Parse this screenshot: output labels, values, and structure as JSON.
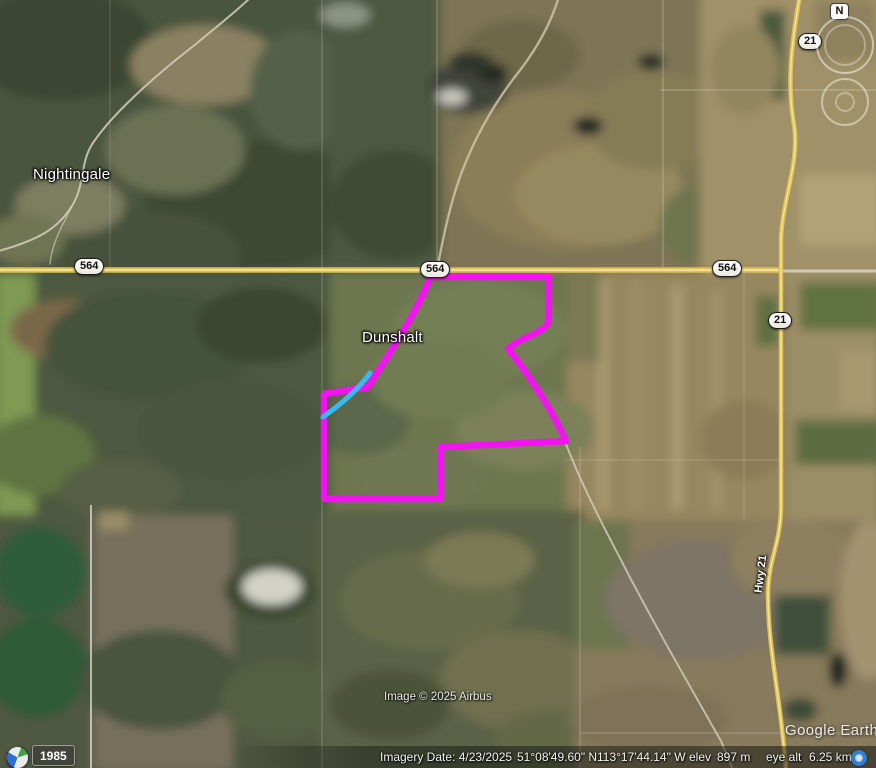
{
  "map": {
    "place_labels": {
      "nightingale": "Nightingale",
      "dunshalt": "Dunshalt"
    },
    "road_labels": {
      "hwy21": "Hwy 21"
    },
    "shields": {
      "hwy564": "564",
      "hwy21": "21"
    },
    "attribution": "Image © 2025 Airbus",
    "watermark": "Google Earth"
  },
  "navigation": {
    "north_label": "N"
  },
  "historical_imagery": {
    "year": "1985"
  },
  "status_bar": {
    "imagery_date": "Imagery Date: 4/23/2025",
    "latitude": "51°08'49.60\" N",
    "longitude": "113°17'44.14\" W",
    "elevation_label": "elev",
    "elevation_value": "897 m",
    "eye_altitude_label": "eye alt",
    "eye_altitude_value": "6.25 km"
  },
  "colors": {
    "boundary_magenta": "#f212f2",
    "creek_cyan": "#39b9f2",
    "highway_yellow": "#dfc051"
  }
}
